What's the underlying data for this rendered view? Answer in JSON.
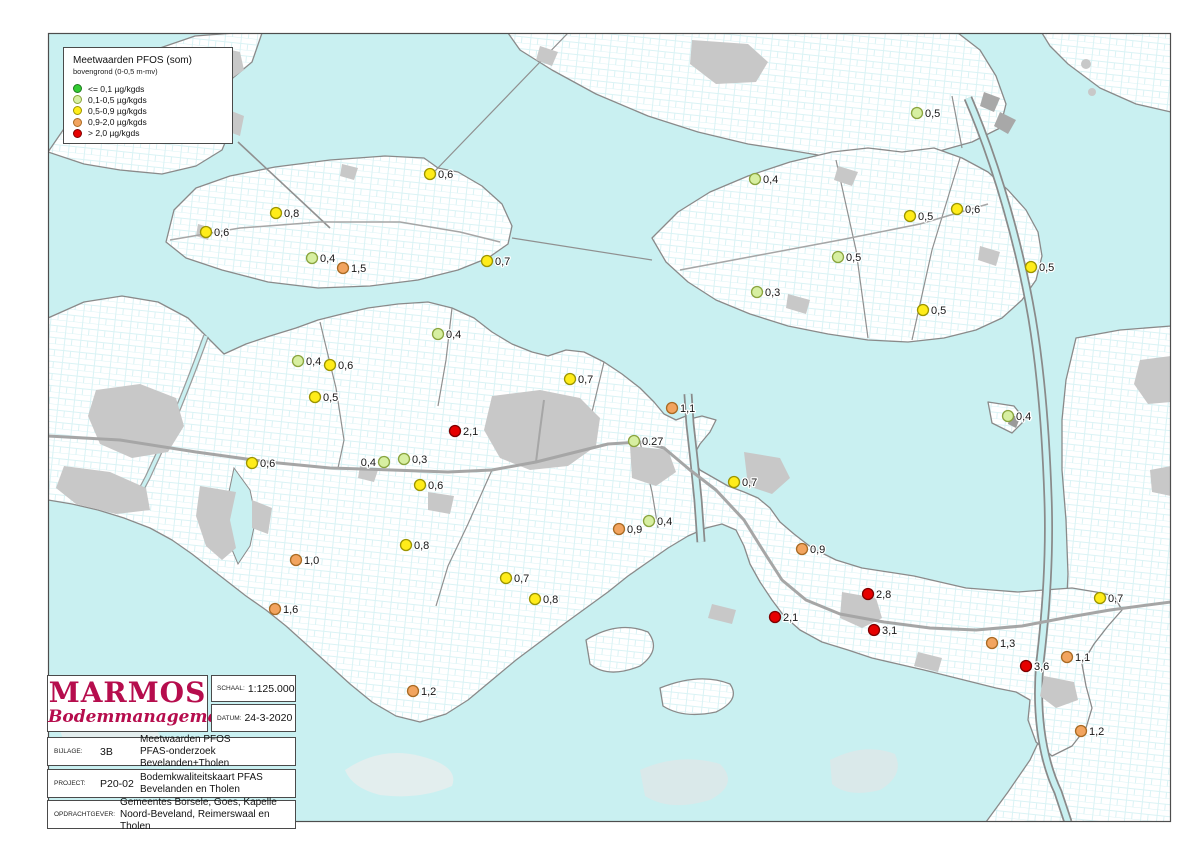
{
  "legend": {
    "title": "Meetwaarden PFOS (som)",
    "subtitle": "bovengrond (0-0,5 m-mv)",
    "items": [
      {
        "label": "<= 0,1 µg/kgds",
        "color": "#33cc33",
        "stroke": "#1f7a1f",
        "level": "green"
      },
      {
        "label": "0,1-0,5 µg/kgds",
        "color": "#d7efa1",
        "stroke": "#8aa43e",
        "level": "lightgreen"
      },
      {
        "label": "0,5-0,9 µg/kgds",
        "color": "#ffec1a",
        "stroke": "#9c9400",
        "level": "yellow"
      },
      {
        "label": "0,9-2,0 µg/kgds",
        "color": "#f2a45f",
        "stroke": "#a96a23",
        "level": "orange"
      },
      {
        "label": "> 2,0 µg/kgds",
        "color": "#e60000",
        "stroke": "#7e0000",
        "level": "red"
      }
    ]
  },
  "title_block": {
    "company_name": "MARMOS",
    "company_subtitle": "Bodemmanagement",
    "schaal_label": "SCHAAL:",
    "schaal_value": "1:125.000",
    "datum_label": "DATUM:",
    "datum_value": "24-3-2020",
    "bijlage_label": "BIJLAGE:",
    "bijlage_value": "3B",
    "bijlage_desc1": "Meetwaarden PFOS",
    "bijlage_desc2": "PFAS-onderzoek Bevelanden+Tholen",
    "project_label": "PROJECT:",
    "project_value": "P20-02",
    "project_desc1": "Bodemkwaliteitskaart PFAS",
    "project_desc2": "Bevelanden en Tholen",
    "opdrachtgever_label": "OPDRACHTGEVER:",
    "opdrachtgever_desc1": "Gemeentes Borsele, Goes, Kapelle",
    "opdrachtgever_desc2": "Noord-Beveland, Reimerswaal en Tholen"
  },
  "map": {
    "colors": {
      "green": {
        "fill": "#33cc33",
        "stroke": "#1f7a1f"
      },
      "lightgreen": {
        "fill": "#d7efa1",
        "stroke": "#8aa43e"
      },
      "yellow": {
        "fill": "#ffec1a",
        "stroke": "#9c9400"
      },
      "orange": {
        "fill": "#f2a45f",
        "stroke": "#a96a23"
      },
      "red": {
        "fill": "#e60000",
        "stroke": "#7e0000"
      },
      "water": "#c9f0f1",
      "urban": "#c8c8c8",
      "coast": "#8a8a8a"
    },
    "points": [
      {
        "x": 430,
        "y": 174,
        "value": "0,6",
        "level": "yellow"
      },
      {
        "x": 276,
        "y": 213,
        "value": "0,8",
        "level": "yellow"
      },
      {
        "x": 206,
        "y": 232,
        "value": "0,6",
        "level": "yellow"
      },
      {
        "x": 312,
        "y": 258,
        "value": "0,4",
        "level": "lightgreen"
      },
      {
        "x": 343,
        "y": 268,
        "value": "1,5",
        "level": "orange"
      },
      {
        "x": 487,
        "y": 261,
        "value": "0,7",
        "level": "yellow"
      },
      {
        "x": 917,
        "y": 113,
        "value": "0,5",
        "level": "lightgreen"
      },
      {
        "x": 755,
        "y": 179,
        "value": "0,4",
        "level": "lightgreen"
      },
      {
        "x": 910,
        "y": 216,
        "value": "0,5",
        "level": "yellow"
      },
      {
        "x": 957,
        "y": 209,
        "value": "0,6",
        "level": "yellow"
      },
      {
        "x": 838,
        "y": 257,
        "value": "0,5",
        "level": "lightgreen"
      },
      {
        "x": 1031,
        "y": 267,
        "value": "0,5",
        "level": "yellow"
      },
      {
        "x": 757,
        "y": 292,
        "value": "0,3",
        "level": "lightgreen"
      },
      {
        "x": 923,
        "y": 310,
        "value": "0,5",
        "level": "yellow"
      },
      {
        "x": 438,
        "y": 334,
        "value": "0,4",
        "level": "lightgreen"
      },
      {
        "x": 298,
        "y": 361,
        "value": "0,4",
        "level": "lightgreen"
      },
      {
        "x": 330,
        "y": 365,
        "value": "0,6",
        "level": "yellow"
      },
      {
        "x": 315,
        "y": 397,
        "value": "0,5",
        "level": "yellow"
      },
      {
        "x": 570,
        "y": 379,
        "value": "0,7",
        "level": "yellow"
      },
      {
        "x": 455,
        "y": 431,
        "value": "2,1",
        "level": "red"
      },
      {
        "x": 252,
        "y": 463,
        "value": "0,6",
        "level": "yellow"
      },
      {
        "x": 384,
        "y": 462,
        "value": "0,4",
        "level": "lightgreen",
        "side": "left"
      },
      {
        "x": 404,
        "y": 459,
        "value": "0,3",
        "level": "lightgreen"
      },
      {
        "x": 420,
        "y": 485,
        "value": "0,6",
        "level": "yellow"
      },
      {
        "x": 672,
        "y": 408,
        "value": "1,1",
        "level": "orange"
      },
      {
        "x": 634,
        "y": 441,
        "value": "0.27",
        "level": "lightgreen"
      },
      {
        "x": 734,
        "y": 482,
        "value": "0,7",
        "level": "yellow"
      },
      {
        "x": 649,
        "y": 521,
        "value": "0,4",
        "level": "lightgreen"
      },
      {
        "x": 619,
        "y": 529,
        "value": "0,9",
        "level": "orange"
      },
      {
        "x": 802,
        "y": 549,
        "value": "0,9",
        "level": "orange"
      },
      {
        "x": 1008,
        "y": 416,
        "value": "0,4",
        "level": "lightgreen"
      },
      {
        "x": 406,
        "y": 545,
        "value": "0,8",
        "level": "yellow"
      },
      {
        "x": 296,
        "y": 560,
        "value": "1,0",
        "level": "orange"
      },
      {
        "x": 506,
        "y": 578,
        "value": "0,7",
        "level": "yellow"
      },
      {
        "x": 535,
        "y": 599,
        "value": "0,8",
        "level": "yellow"
      },
      {
        "x": 275,
        "y": 609,
        "value": "1,6",
        "level": "orange"
      },
      {
        "x": 413,
        "y": 691,
        "value": "1,2",
        "level": "orange"
      },
      {
        "x": 868,
        "y": 594,
        "value": "2,8",
        "level": "red"
      },
      {
        "x": 1100,
        "y": 598,
        "value": "0,7",
        "level": "yellow"
      },
      {
        "x": 775,
        "y": 617,
        "value": "2,1",
        "level": "red"
      },
      {
        "x": 874,
        "y": 630,
        "value": "3,1",
        "level": "red"
      },
      {
        "x": 992,
        "y": 643,
        "value": "1,3",
        "level": "orange"
      },
      {
        "x": 1067,
        "y": 657,
        "value": "1,1",
        "level": "orange"
      },
      {
        "x": 1026,
        "y": 666,
        "value": "3,6",
        "level": "red"
      },
      {
        "x": 1081,
        "y": 731,
        "value": "1,2",
        "level": "orange"
      }
    ]
  }
}
